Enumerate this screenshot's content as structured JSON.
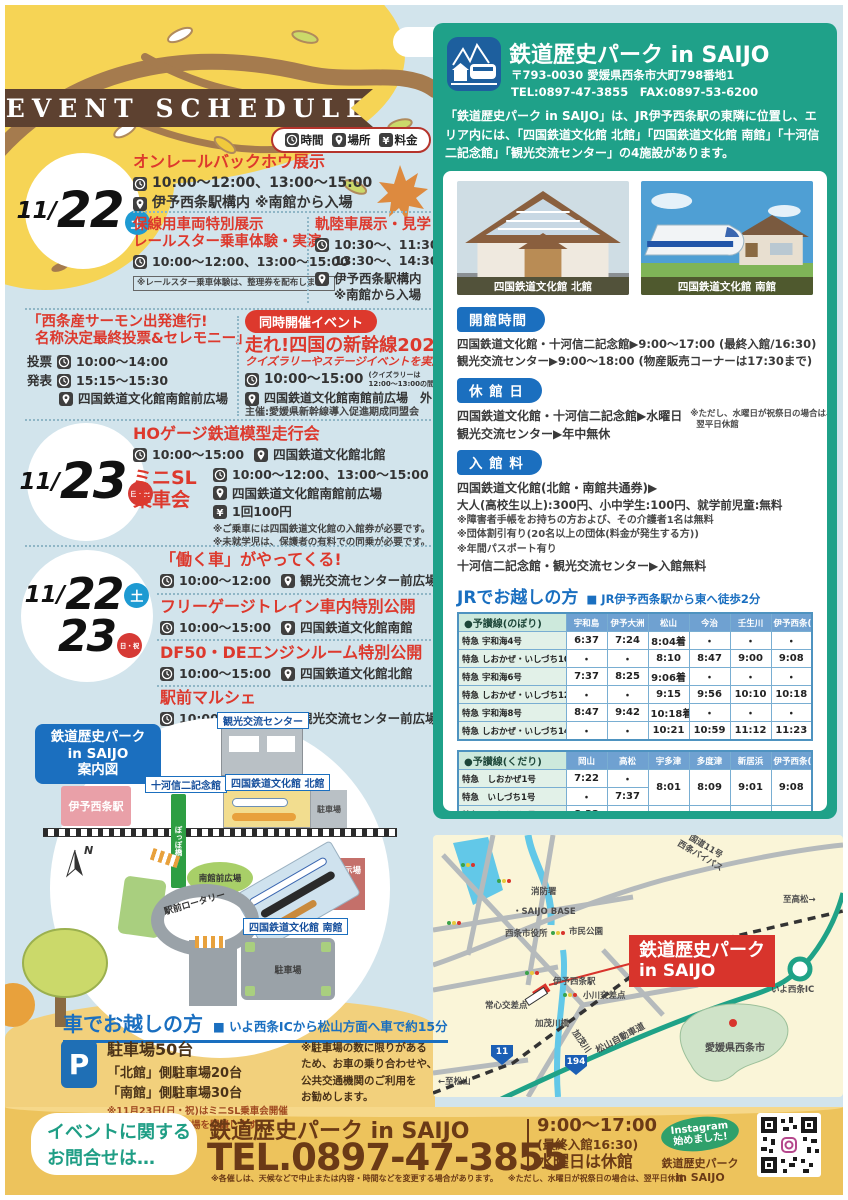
{
  "sched": {
    "banner": "EVENT SCHEDULE",
    "legend": {
      "time": "時間",
      "place": "場所",
      "fee": "料金"
    },
    "d1": {
      "m": "11/",
      "d": "22",
      "w": "土"
    },
    "e1": {
      "title": "オンレールバックホウ展示",
      "time": "10:00〜12:00、13:00〜15:00",
      "place": "伊予西条駅構内 ※南館から入場"
    },
    "e2": {
      "t1": "保線用車両特別展示",
      "t2": "レールスター乗車体験・実演",
      "time": "10:00〜12:00、13:00〜15:00",
      "note": "※レールスター乗車体験は、整理券を配布します。"
    },
    "e3": {
      "title": "軌陸車展示・見学",
      "time1": "10:30〜、11:30〜、",
      "time2": "13:30〜、14:30〜",
      "place1": "伊予西条駅構内",
      "place2": "※南館から入場"
    },
    "e4": {
      "t1": "「西条産サーモン出発進行!",
      "t2": "名称決定最終投票&セレモニー」",
      "vote": "投票",
      "vtime": "10:00〜14:00",
      "ann": "発表",
      "atime": "15:15〜15:30",
      "place": "四国鉄道文化館南館前広場"
    },
    "e5": {
      "badge": "同時開催イベント",
      "title": "走れ!四国の新幹線2025",
      "sub": "クイズラリーやステージイベントを実施",
      "time": "10:00〜15:00",
      "tnote1": "(クイズラリーは",
      "tnote2": "12:00〜13:00の間休止)",
      "place": "四国鉄道文化館南館前広場　外",
      "host": "主催:愛媛県新幹線導入促進期成同盟会"
    },
    "d2": {
      "m": "11/",
      "d": "23",
      "w": "日・祝"
    },
    "e6": {
      "title": "HOゲージ鉄道模型走行会",
      "time": "10:00〜15:00",
      "place": "四国鉄道文化館北館"
    },
    "e7": {
      "t1": "ミニSL",
      "t2": "乗車会",
      "time": "10:00〜12:00、13:00〜15:00",
      "rain": "※雨天中止",
      "place": "四国鉄道文化館南館前広場",
      "fee": "1回100円",
      "n1": "※ご乗車には四国鉄道文化館の入館券が必要です。",
      "n2": "※未就学児は、保護者の有料での同乗が必要です。"
    },
    "d3": {
      "m": "11/",
      "d1": "22",
      "w1": "土",
      "d2": "23",
      "w2": "日・祝"
    },
    "e8": {
      "title": "「働く車」がやってくる!",
      "time": "10:00〜12:00",
      "place": "観光交流センター前広場"
    },
    "e9": {
      "title": "フリーゲージトレイン車内特別公開",
      "time": "10:00〜15:00",
      "place": "四国鉄道文化館南館"
    },
    "e10": {
      "title": "DF50・DEエンジンルーム特別公開",
      "time": "10:00〜15:00",
      "place": "四国鉄道文化館北館"
    },
    "e11": {
      "title": "駅前マルシェ",
      "time": "10:00〜15:00",
      "place": "観光交流センター前広場"
    }
  },
  "guide": {
    "title1": "鉄道歴史パーク",
    "title2": "in SAIJO",
    "title3": "案内図",
    "station": "伊予西条駅",
    "kanko": "観光交流センター",
    "sogo": "十河信二記念館",
    "north": "四国鉄道文化館 北館",
    "south": "四国鉄道文化館 南館",
    "p1": "駐車場",
    "p2": "駐車場",
    "plaza": "南館前広場",
    "rotary": "駅前ロータリー",
    "outdoor": "屋外展示場",
    "bridge": "ぽっぽ橋",
    "compass": "N"
  },
  "car": {
    "heading": "車でお越しの方",
    "sub": "■ いよ西条ICから松山方面へ車で約15分",
    "p_title": "駐車場50台",
    "p_north": "「北館」側駐車場20台",
    "p_south": "「南館」側駐車場30台",
    "p_note1": "※11月23日(日・祝)はミニSL乗車会開催",
    "p_note2": "のため、南館駐車場を閉鎖します。",
    "note1": "※駐車場の数に限りがある",
    "note2": "ため、お車の乗り合わせや、",
    "note3": "公共交通機関のご利用を",
    "note4": "お勧めします。"
  },
  "park": {
    "name": "鉄道歴史パーク in SAIJO",
    "addr": "〒793-0030 愛媛県西条市大町798番地1",
    "tel": "TEL:0897-47-3855　FAX:0897-53-6200",
    "desc": "「鉄道歴史パーク in SAIJO」は、JR伊予西条駅の東隣に位置し、エリア内には、「四国鉄道文化館 北館」「四国鉄道文化館 南館」「十河信二記念館」「観光交流センター」の4施設があります。",
    "cap1": "四国鉄道文化館 北館",
    "cap2": "四国鉄道文化館 南館",
    "hours_badge": "開館時間",
    "hours1": "四国鉄道文化館・十河信二記念館▶9:00〜17:00 (最終入館/16:30)",
    "hours2": "観光交流センター▶9:00〜18:00 (物産販売コーナーは17:30まで)",
    "closed_badge": "休 館 日",
    "closed1": "四国鉄道文化館・十河信二記念館▶水曜日",
    "closed_note1": "※ただし、水曜日が祝祭日の場合は、",
    "closed_note2": "翌平日休館",
    "closed2": "観光交流センター▶年中無休",
    "fee_badge": "入 館 料",
    "fee1": "四国鉄道文化館(北館・南館共通券)▶",
    "fee2": "大人(高校生以上):300円、小中学生:100円、就学前児童:無料",
    "fee_n1": "※障害者手帳をお持ちの方および、その介護者1名は無料",
    "fee_n2": "※団体割引有り(20名以上の団体(料金が発生する方))",
    "fee_n3": "※年間パスポート有り",
    "fee3": "十河信二記念館・観光交流センター▶入館無料"
  },
  "jr": {
    "heading": "JRでお越しの方",
    "sub": "■ JR伊予西条駅から東へ徒歩2分",
    "up": {
      "header": [
        "●予讃線(のぼり)",
        "宇和島",
        "伊予大洲",
        "松山",
        "今治",
        "壬生川",
        "伊予西条(着)"
      ],
      "rows": [
        {
          "n": "特急 宇和海4号",
          "c": [
            "6:37",
            "7:24",
            "8:04着",
            "・",
            "・",
            "・"
          ]
        },
        {
          "n": "特急 しおかぜ・いしづち10号",
          "c": [
            "・",
            "・",
            "8:10",
            "8:47",
            "9:00",
            "9:08"
          ]
        },
        {
          "n": "特急 宇和海6号",
          "c": [
            "7:37",
            "8:25",
            "9:06着",
            "・",
            "・",
            "・"
          ]
        },
        {
          "n": "特急 しおかぜ・いしづち12号",
          "c": [
            "・",
            "・",
            "9:15",
            "9:56",
            "10:10",
            "10:18"
          ]
        },
        {
          "n": "特急 宇和海8号",
          "c": [
            "8:47",
            "9:42",
            "10:18着",
            "・",
            "・",
            "・"
          ]
        },
        {
          "n": "特急 しおかぜ・いしづち14号",
          "c": [
            "・",
            "・",
            "10:21",
            "10:59",
            "11:12",
            "11:23"
          ]
        }
      ]
    },
    "down": {
      "header": [
        "●予讃線(くだり)",
        "岡山",
        "高松",
        "宇多津",
        "多度津",
        "新居浜",
        "伊予西条(着)"
      ],
      "rows": [
        {
          "n": "特急　しおかぜ1号",
          "a": "7:22",
          "b": "・"
        },
        {
          "n": "特急　いしづち1号",
          "a": "・",
          "b": "7:37"
        },
        {
          "n": "特急　しおかぜ3号",
          "a": "8:32",
          "b": "・"
        },
        {
          "n": "特急　いしづち3号",
          "a": "・",
          "b": "8:45"
        },
        {
          "n": "特急　しおかぜ5号",
          "a": "9:25",
          "b": "・"
        },
        {
          "n": "特急　いしづち5号",
          "a": "・",
          "b": ""
        }
      ],
      "m": [
        [
          "8:01",
          "8:09",
          "9:01",
          "9:08"
        ],
        [
          "9:13",
          "9:21",
          "10:11",
          "10:18"
        ],
        [
          "10:06",
          "10:15",
          "11:03",
          "11:11"
        ]
      ]
    }
  },
  "area": {
    "r11": "国道11号",
    "bypass": "西条バイパス",
    "takamatsu": "至高松→",
    "fire": "消防署",
    "base": "・SAIJO BASE",
    "cityhall": "西条市役所",
    "cpark": "市民公園",
    "station": "伊予西条駅",
    "ogawa": "小川交差点",
    "tsunesin": "常心交差点",
    "kamo_bridge": "加茂川橋",
    "kamo_river": "加茂川",
    "expwy": "松山自動車道",
    "ic": "いよ西条IC",
    "ehime": "愛媛県西条市",
    "matsuyama": "←至松山",
    "park1": "鉄道歴史パーク",
    "park2": "in SAIJO",
    "s11": "11",
    "s194": "194"
  },
  "footer": {
    "c1": "イベントに関する",
    "c2": "お問合せは…",
    "name": "鉄道歴史パーク in SAIJO",
    "tel": "TEL.0897-47-3855",
    "h1": "9:00〜17:00",
    "h2": "(最終入館16:30)",
    "h3": "水曜日は休館",
    "n1": "※各催しは、天候などで中止または内容・時間などを変更する場合があります。",
    "n2": "※ただし、水曜日が祝祭日の場合は、翌平日休館",
    "ig1": "Instagram",
    "ig2": "始めました!",
    "ig3": "鉄道歴史パーク",
    "ig4": "in SAIJO"
  }
}
